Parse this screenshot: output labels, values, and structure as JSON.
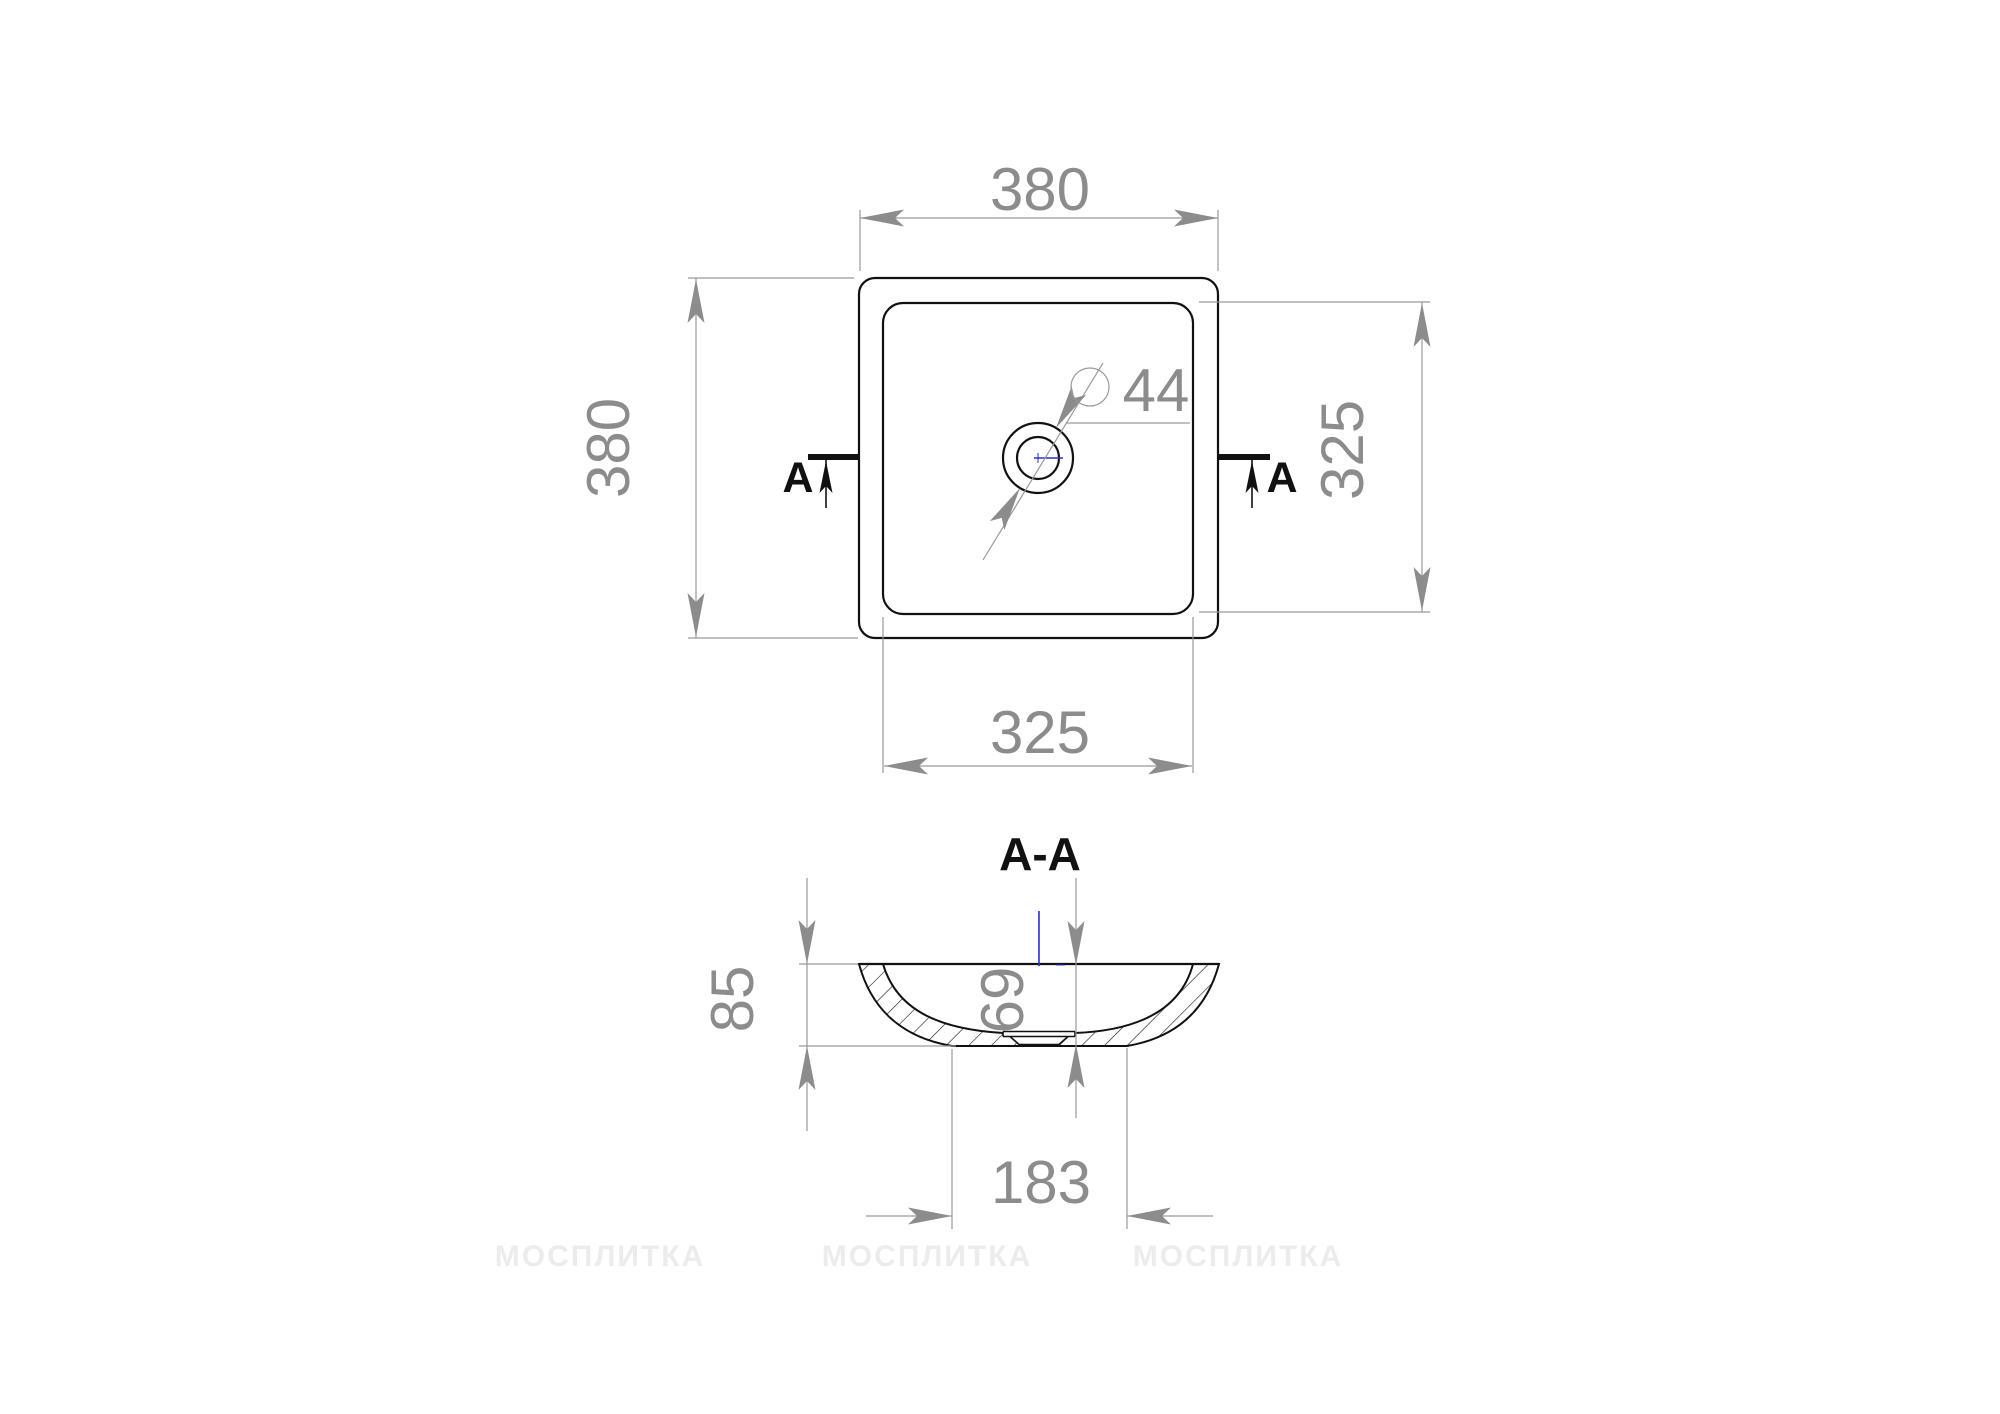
{
  "colors": {
    "line": "#111111",
    "dimension": "#8c8c8c",
    "dim_line": "#9a9a9a",
    "centerline": "#2b2fd4",
    "watermark": "#ececec"
  },
  "top_view": {
    "outer_width": "380",
    "outer_height": "380",
    "inner_width": "325",
    "inner_height": "325",
    "drain_diameter": "44",
    "section_label_left": "A",
    "section_label_right": "A"
  },
  "section_view": {
    "title": "A-A",
    "height": "85",
    "depth": "69",
    "base_width": "183"
  },
  "watermark": {
    "text": "МОСПЛИТКА"
  }
}
